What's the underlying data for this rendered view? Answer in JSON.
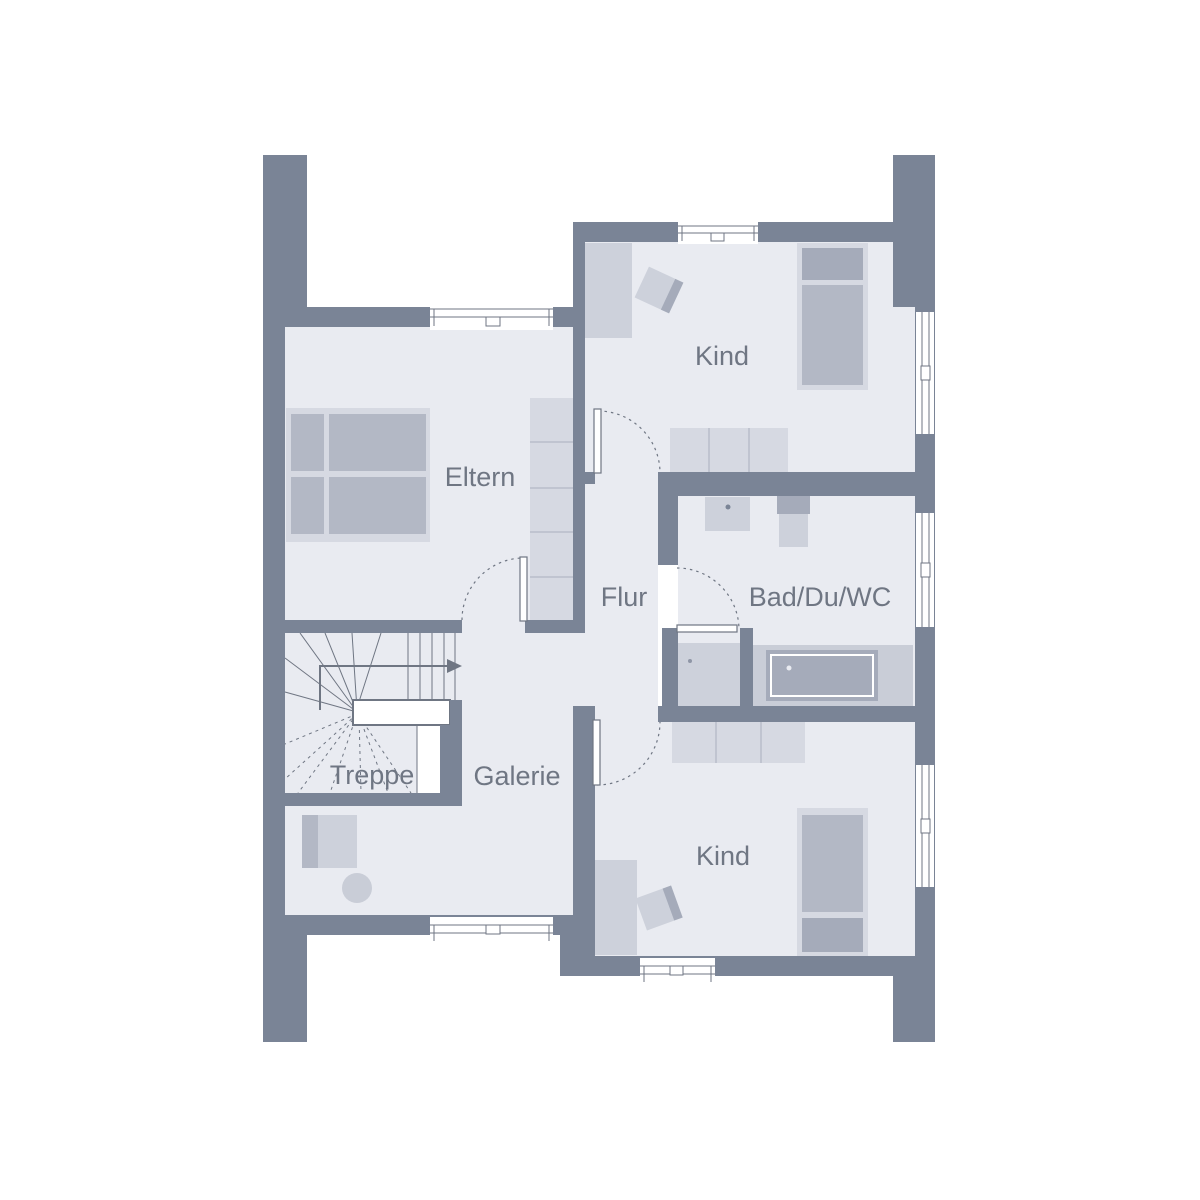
{
  "floorplan": {
    "rooms": [
      {
        "id": "eltern",
        "label": "Eltern"
      },
      {
        "id": "kind_top",
        "label": "Kind"
      },
      {
        "id": "flur",
        "label": "Flur"
      },
      {
        "id": "bad",
        "label": "Bad/Du/WC"
      },
      {
        "id": "treppe",
        "label": "Treppe"
      },
      {
        "id": "galerie",
        "label": "Galerie"
      },
      {
        "id": "kind_bottom",
        "label": "Kind"
      }
    ],
    "palette": {
      "wall": "#7a8496",
      "floor": "#e9ebf1",
      "furniture_light": "#d6d9e2",
      "furniture_mid": "#cdd1db",
      "furniture_medium": "#b3b8c5",
      "furniture_dark": "#a5abba",
      "outline": "#6f7683",
      "background": "#ffffff"
    }
  }
}
